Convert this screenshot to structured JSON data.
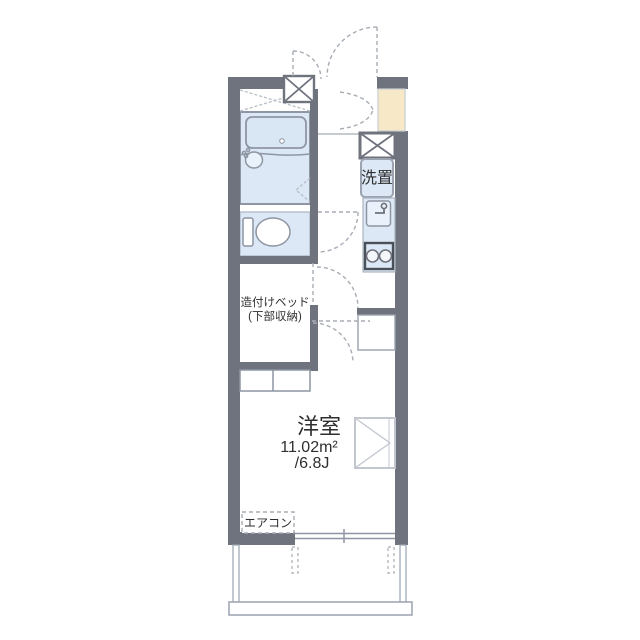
{
  "plan": {
    "title": "one-room apartment floor plan",
    "labels": {
      "washer": "洗置",
      "bed_line1": "造付けベッド",
      "bed_line2": "(下部収納)",
      "room_name": "洋室",
      "room_area_m2": "11.02m²",
      "room_area_jo": "/6.8J",
      "aircon": "エアコン"
    },
    "colors": {
      "wall": "#6f737e",
      "water_area_fill": "#dce8f6",
      "shoe_cabinet_fill": "#f7e9c7",
      "fixture_line": "#8e96a3",
      "door_dash_line": "#a7adb5",
      "text": "#2f2f2f",
      "background": "#ffffff"
    }
  }
}
